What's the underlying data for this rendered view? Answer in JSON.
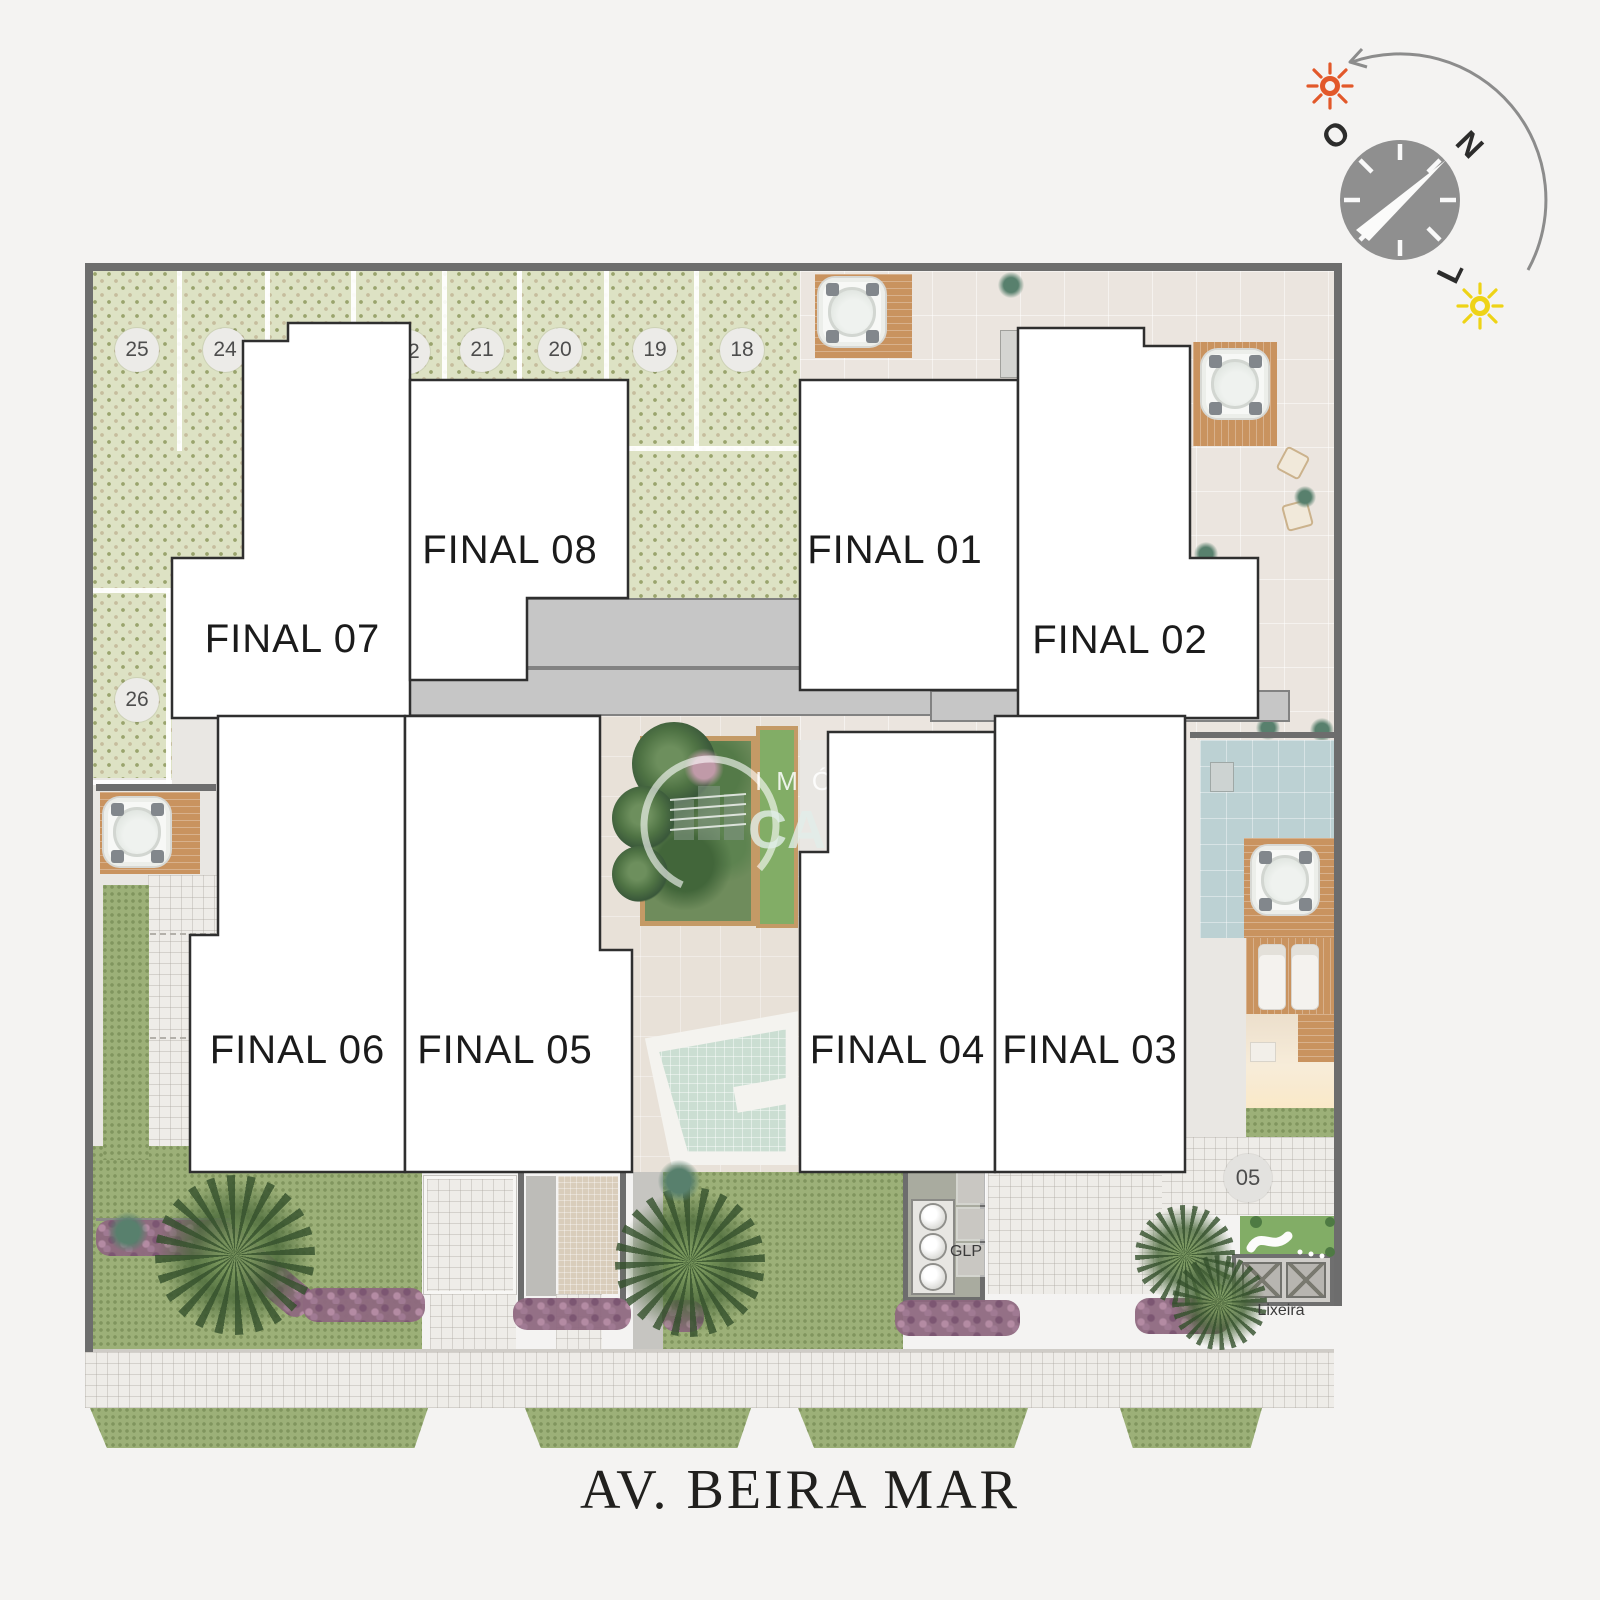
{
  "units": [
    {
      "id": "final-01",
      "label": "FINAL 01"
    },
    {
      "id": "final-02",
      "label": "FINAL 02"
    },
    {
      "id": "final-03",
      "label": "FINAL 03"
    },
    {
      "id": "final-04",
      "label": "FINAL 04"
    },
    {
      "id": "final-05",
      "label": "FINAL 05"
    },
    {
      "id": "final-06",
      "label": "FINAL 06"
    },
    {
      "id": "final-07",
      "label": "FINAL 07"
    },
    {
      "id": "final-08",
      "label": "FINAL 08"
    }
  ],
  "parking": [
    "25",
    "24",
    "22",
    "21",
    "20",
    "19",
    "18",
    "26",
    "05"
  ],
  "labels": {
    "gas": "GLP",
    "trash": "Lixeira"
  },
  "street": {
    "name": "AV. BEIRA MAR"
  },
  "compass": {
    "north": "N",
    "west": "O",
    "east": "L"
  },
  "watermark": {
    "line1": "IMÓ",
    "line2": "CA"
  },
  "colors": {
    "background": "#f4f3f2",
    "trellis_paving": "#dde2c4",
    "terrace": "#ebe5df",
    "grass": "#9cb078",
    "pool_water": "#cbded2",
    "pool_room": "#bcd1d3",
    "wood_deck": "#c9935f",
    "core_gray": "#c6c6c6",
    "unit_fill": "#ffffff",
    "unit_border": "#2f2f2f",
    "wall": "#6d6d6d",
    "sun_west": "#e2582a",
    "sun_east": "#eed316",
    "street_text": "#21201e"
  }
}
